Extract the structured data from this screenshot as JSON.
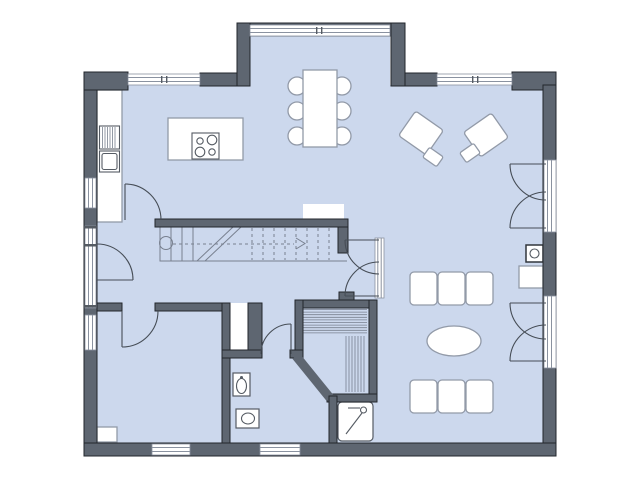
{
  "meta": {
    "kind": "architectural-floor-plan",
    "visible_text": []
  },
  "colors": {
    "background": "#ffffff",
    "floor": "#ccd8ed",
    "wall": "#5e6671",
    "wall_outline": "#22262c",
    "furniture_stroke": "#929aa8",
    "fixture_stroke": "#555b63",
    "window_line": "#8a92a0",
    "door_arc": "#464d56",
    "stair_line": "#78808f"
  },
  "elements": {
    "structure": [
      "exterior-walls",
      "interior-walls",
      "bay-window-top",
      "windows",
      "entry-door",
      "interior-doors",
      "double-french-doors",
      "stair-run-with-arrow"
    ],
    "kitchen": [
      "kitchen-counter",
      "appliance-lined",
      "appliance-square",
      "kitchen-island",
      "cooktop-4-burners"
    ],
    "dining": [
      "dining-table",
      "six-dining-chairs"
    ],
    "living": [
      "two-lounge-chairs",
      "two-ottomans",
      "two-three-seat-sofas",
      "oval-coffee-table",
      "wood-stove",
      "hearth-plate"
    ],
    "bathroom": [
      "washbasin",
      "toilet",
      "shower-cabin"
    ],
    "wellness": [
      "sauna-with-benches",
      "sauna-heater-chimney"
    ],
    "office": [
      "corner-shelf-niche"
    ]
  }
}
